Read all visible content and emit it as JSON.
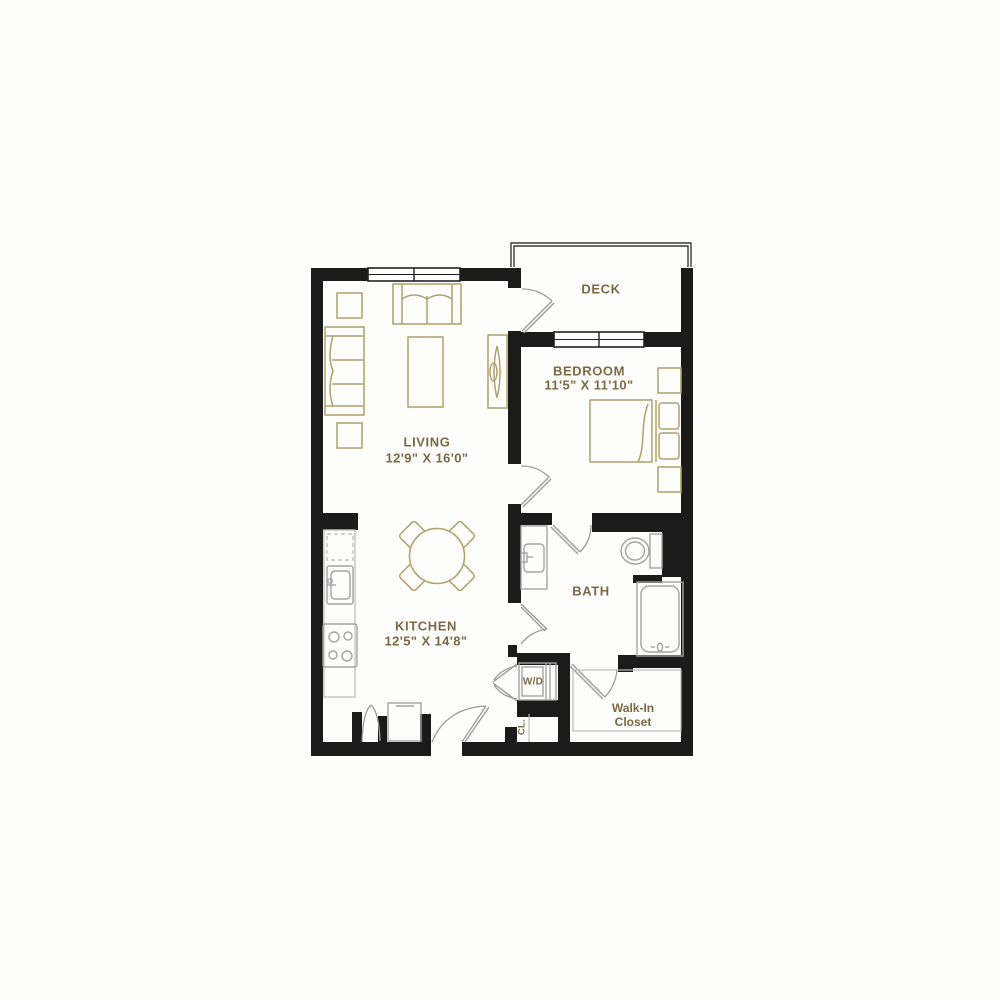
{
  "plan_title": "One bedroom apartment floor plan",
  "colors": {
    "wall": "#1b1b1b",
    "furniture_outline": "#b2a06b",
    "fixture_outline": "#a3a3a3",
    "counter_outline": "#c2c2c2",
    "label_text": "#7b6946",
    "background": "#fdfdfc"
  },
  "rooms": {
    "deck": {
      "label": "DECK"
    },
    "bedroom": {
      "label": "BEDROOM",
      "dimensions": "11'5\" X 11'10\""
    },
    "living": {
      "label": "LIVING",
      "dimensions": "12'9\" X 16'0\""
    },
    "kitchen": {
      "label": "KITCHEN",
      "dimensions": "12'5\" X 14'8\""
    },
    "bath": {
      "label": "BATH"
    },
    "walk_in_closet": {
      "line1": "Walk-In",
      "line2": "Closet"
    },
    "washer_dryer": {
      "label": "W/D"
    },
    "closet": {
      "label": "CL."
    }
  }
}
